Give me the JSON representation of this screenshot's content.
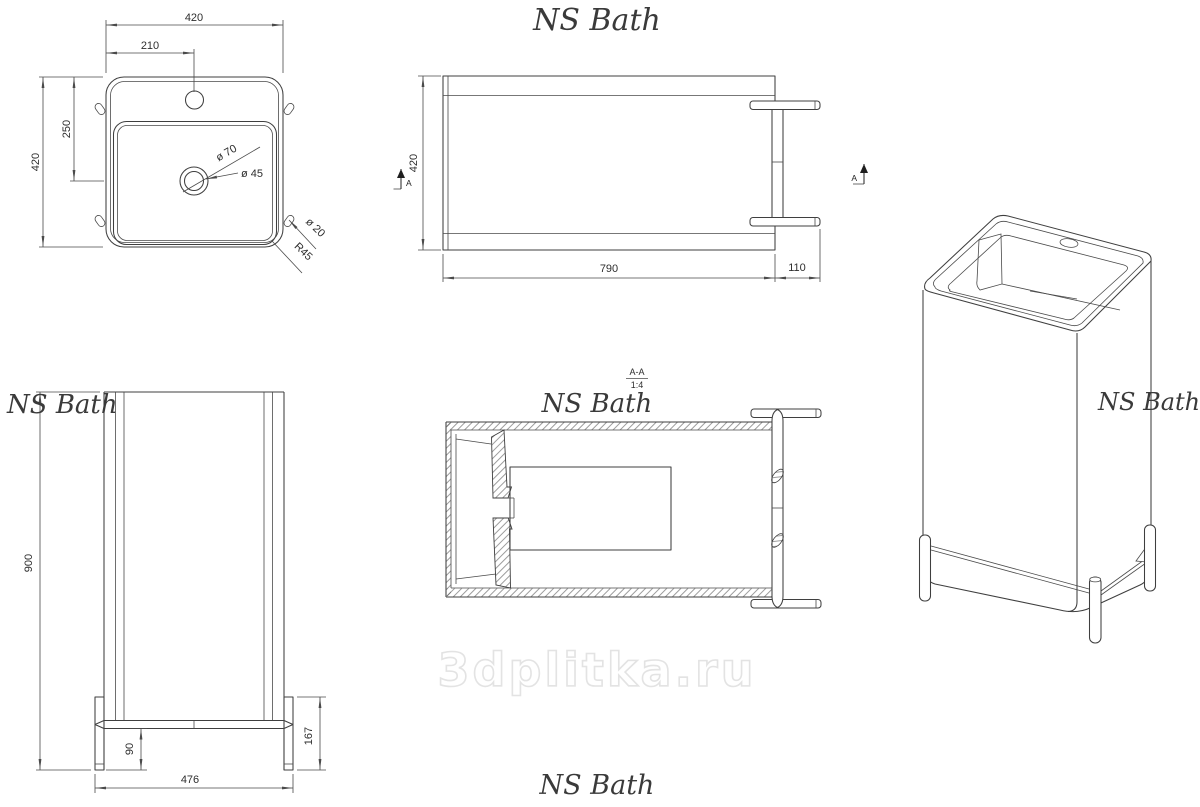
{
  "brand": {
    "logo": "NS Bath"
  },
  "watermark": {
    "text": "3dplitka.ru"
  },
  "section": {
    "title": "A-A",
    "scale": "1:4",
    "marker": "A"
  },
  "dims": {
    "top": {
      "width": "420",
      "faucet": "210",
      "depth": "420",
      "drain_offset": "250",
      "drain_outer": "ø 70",
      "drain_inner": "ø 45",
      "side_hole": "ø 20",
      "corner_radius": "R45"
    },
    "plan": {
      "depth": "420",
      "body": "790",
      "leg": "110"
    },
    "front": {
      "height": "900",
      "ground_clearance": "90",
      "leg_height": "167",
      "base_width": "476"
    }
  },
  "colors": {
    "line": "#3f3f3f",
    "dimension": "#4a4a4a",
    "logo": "#3a3a3a",
    "watermark_stroke": "#e3e3e3",
    "background": "#ffffff"
  }
}
